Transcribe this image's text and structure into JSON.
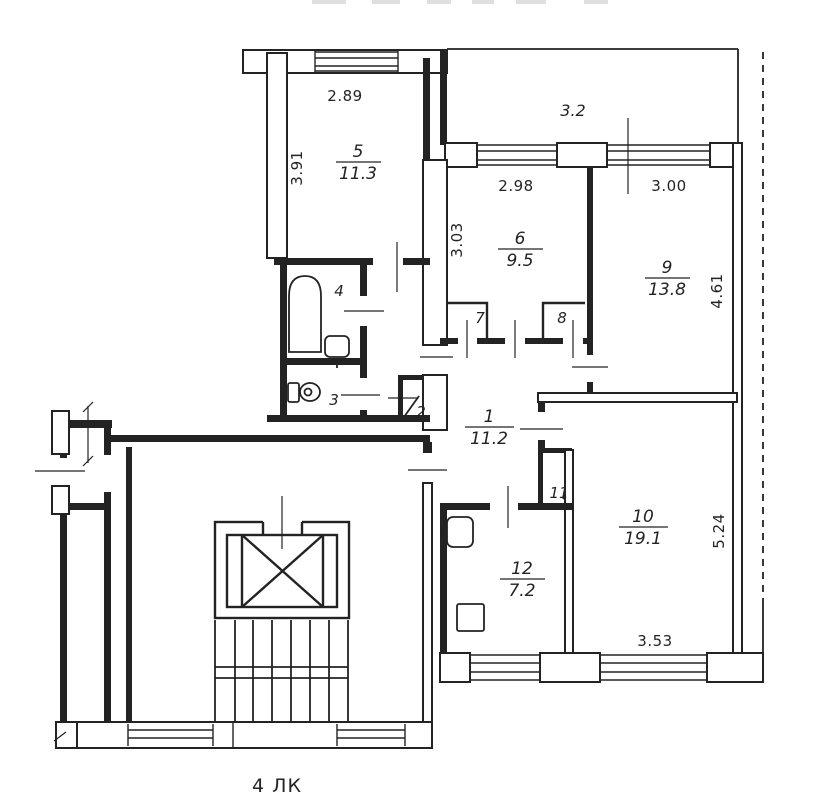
{
  "drawing": {
    "floor_label": "4 ЛК",
    "rooms": {
      "r5": {
        "number": "5",
        "area": "11.3"
      },
      "r6": {
        "number": "6",
        "area": "9.5"
      },
      "r9": {
        "number": "9",
        "area": "13.8"
      },
      "r1": {
        "number": "1",
        "area": "11.2"
      },
      "r10": {
        "number": "10",
        "area": "19.1"
      },
      "r12": {
        "number": "12",
        "area": "7.2"
      },
      "r4": {
        "number": "4"
      },
      "r3": {
        "number": "3"
      },
      "r2": {
        "number": "2"
      },
      "r7": {
        "number": "7"
      },
      "r8": {
        "number": "8"
      },
      "r11": {
        "number": "11"
      }
    },
    "dimensions": {
      "room5_width": "2.89",
      "room5_depth": "3.91",
      "balcony_width": "3.2",
      "room6_width": "2.98",
      "room6_depth": "3.03",
      "room9_width": "3.00",
      "room9_depth": "4.61",
      "room10_depth": "5.24",
      "room10_width": "3.53"
    }
  }
}
